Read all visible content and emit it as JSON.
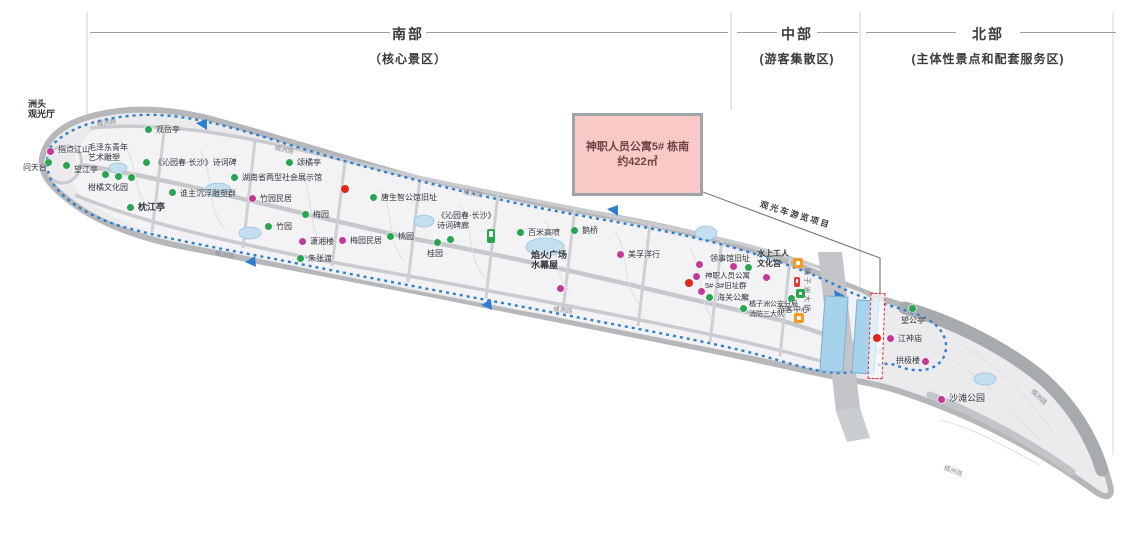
{
  "regions": {
    "south": {
      "title": "南部",
      "subtitle": "（核心景区）"
    },
    "middle": {
      "title": "中部",
      "subtitle": "(游客集散区)"
    },
    "north": {
      "title": "北部",
      "subtitle": "(主体性景点和配套服务区)"
    }
  },
  "callout": {
    "line1": "神职人员公寓5# 栋南",
    "line2": "约422㎡"
  },
  "colors": {
    "green_poi": "#28a550",
    "magenta_poi": "#c23a97",
    "red_poi": "#e3241d",
    "route_blue": "#2f7fd0",
    "callout_fill": "#f8c9c6",
    "callout_text": "#6d4543",
    "island_fill": "#ebebed",
    "island_band": "#b5b7ba",
    "pool_blue": "#a6d2ec"
  },
  "map": {
    "pois": [
      {
        "dot": "magenta",
        "x": 50,
        "y": 151,
        "label": "指点江山",
        "lx": 58,
        "ly": 145
      },
      {
        "dot": "green",
        "x": 48,
        "y": 162,
        "label": "问天台",
        "lx": 23,
        "ly": 163
      },
      {
        "dot": "green",
        "x": 66,
        "y": 165,
        "label": "望江亭",
        "lx": 74,
        "ly": 165
      },
      {
        "dot": "green",
        "x": 105,
        "y": 174
      },
      {
        "dot": "green",
        "x": 118,
        "y": 176
      },
      {
        "dot": "green",
        "x": 131,
        "y": 177
      },
      {
        "dot": "green",
        "x": 148,
        "y": 129,
        "label": "观岳亭",
        "lx": 156,
        "ly": 125
      },
      {
        "dot": "green",
        "x": 146,
        "y": 162,
        "label": "《沁园春·长沙》诗词碑",
        "lx": 154,
        "ly": 158
      },
      {
        "dot": "green",
        "x": 172,
        "y": 192,
        "label": "谁主沉浮雕塑群",
        "lx": 180,
        "ly": 189
      },
      {
        "dot": "green",
        "x": 130,
        "y": 207,
        "label": "枕江亭",
        "lx": 138,
        "ly": 203,
        "bold": true,
        "size": 9
      },
      {
        "dot": "green",
        "x": 234,
        "y": 177,
        "label": "湖南省两型社会展示馆",
        "lx": 242,
        "ly": 173
      },
      {
        "dot": "green",
        "x": 289,
        "y": 162,
        "label": "颂橘亭",
        "lx": 297,
        "ly": 158
      },
      {
        "dot": "magenta",
        "x": 252,
        "y": 198,
        "label": "竹园民居",
        "lx": 260,
        "ly": 194
      },
      {
        "dot": "green",
        "x": 268,
        "y": 226,
        "label": "竹园",
        "lx": 276,
        "ly": 222
      },
      {
        "dot": "green",
        "x": 305,
        "y": 214,
        "label": "梅园",
        "lx": 313,
        "ly": 210
      },
      {
        "dot": "magenta",
        "x": 302,
        "y": 241,
        "label": "潇湘楼",
        "lx": 310,
        "ly": 237
      },
      {
        "dot": "magenta",
        "x": 342,
        "y": 240,
        "label": "梅园民居",
        "lx": 350,
        "ly": 236
      },
      {
        "dot": "green",
        "x": 300,
        "y": 258,
        "label": "朱张渡",
        "lx": 308,
        "ly": 254
      },
      {
        "dot": "red",
        "x": 345,
        "y": 189
      },
      {
        "dot": "green",
        "x": 373,
        "y": 197,
        "label": "唐生智公馆旧址",
        "lx": 381,
        "ly": 193
      },
      {
        "dot": "green",
        "x": 390,
        "y": 236,
        "label": "桃园",
        "lx": 398,
        "ly": 232
      },
      {
        "dot": "green",
        "x": 437,
        "y": 242,
        "label": "桂园",
        "lx": 427,
        "ly": 249
      },
      {
        "dot": "green",
        "x": 450,
        "y": 239
      },
      {
        "dot": "green",
        "x": 520,
        "y": 232,
        "label": "百米高喷",
        "lx": 528,
        "ly": 228
      },
      {
        "dot": "green",
        "x": 574,
        "y": 230,
        "label": "鹅桥",
        "lx": 582,
        "ly": 226
      },
      {
        "dot": "magenta",
        "x": 560,
        "y": 288
      },
      {
        "dot": "magenta",
        "x": 620,
        "y": 254,
        "label": "美孚洋行",
        "lx": 628,
        "ly": 250
      },
      {
        "dot": "magenta",
        "x": 699,
        "y": 264
      },
      {
        "dot": "magenta",
        "x": 696,
        "y": 276
      },
      {
        "dot": "magenta",
        "x": 701,
        "y": 291
      },
      {
        "dot": "red",
        "x": 689,
        "y": 283
      },
      {
        "dot": "magenta",
        "x": 733,
        "y": 266,
        "label": "领事馆旧址",
        "lx": 710,
        "ly": 254
      },
      {
        "dot": "green",
        "x": 748,
        "y": 267
      },
      {
        "dot": "magenta",
        "x": 766,
        "y": 277
      },
      {
        "dot": "green",
        "x": 709,
        "y": 297,
        "label": "海关公廨",
        "lx": 717,
        "ly": 293
      },
      {
        "dot": "green",
        "x": 743,
        "y": 308
      },
      {
        "dot": "green",
        "x": 791,
        "y": 298,
        "label": "游客中心",
        "lx": 777,
        "ly": 305
      },
      {
        "dot": "red",
        "x": 877,
        "y": 338
      },
      {
        "dot": "green",
        "x": 912,
        "y": 308,
        "label": "望公亭",
        "lx": 901,
        "ly": 316
      },
      {
        "dot": "magenta",
        "x": 890,
        "y": 338,
        "label": "江神庙",
        "lx": 898,
        "ly": 334
      },
      {
        "dot": "magenta",
        "x": 925,
        "y": 361,
        "label": "拱极楼",
        "lx": 896,
        "ly": 356
      },
      {
        "dot": "magenta",
        "x": 941,
        "y": 399,
        "label": "沙滩公园",
        "lx": 949,
        "ly": 394,
        "size": 9
      }
    ],
    "text_blocks": [
      {
        "name": "zhoutou-viewing-hall",
        "lines": [
          "洲头",
          "观光厅"
        ],
        "x": 28,
        "y": 100,
        "size": 9,
        "bold": true
      },
      {
        "name": "mao-youth-sculpture",
        "lines": [
          "毛泽东青年",
          "艺术雕塑"
        ],
        "x": 88,
        "y": 143,
        "size": 8
      },
      {
        "name": "citrus-culture-garden",
        "lines": [
          "柑橘文化园"
        ],
        "x": 88,
        "y": 183,
        "size": 8
      },
      {
        "name": "poem-stele-gallery",
        "lines": [
          "《沁园春·长沙》",
          "诗词碑廊"
        ],
        "x": 437,
        "y": 211,
        "size": 8
      },
      {
        "name": "fireworks-square",
        "lines": [
          "焰火广场",
          "水幕屋"
        ],
        "x": 531,
        "y": 251,
        "size": 9,
        "bold": true
      },
      {
        "name": "clergy-apartments-group",
        "lines": [
          "神职人员公寓",
          "5#·3#旧址群"
        ],
        "x": 705,
        "y": 271,
        "size": 7.5
      },
      {
        "name": "waterside-workers-culture-palace",
        "lines": [
          "水上工人",
          "文化宫"
        ],
        "x": 757,
        "y": 249,
        "size": 8,
        "bold": true
      },
      {
        "name": "police-station",
        "lines": [
          "橘子洲公安分局",
          "消防三大队"
        ],
        "x": 749,
        "y": 300,
        "size": 7
      }
    ],
    "rotated_labels": [
      {
        "name": "sightseeing-bus-route",
        "text": "观光车游览项目",
        "x": 762,
        "y": 198,
        "rot": 17,
        "size": 8.5,
        "color": "#3c4043",
        "bold": true
      },
      {
        "name": "juzizhou-bridge",
        "text": "橘子洲大桥",
        "x": 812,
        "y": 268,
        "rot": 90,
        "size": 7,
        "color": "#6b6f73"
      }
    ],
    "road_labels": [
      {
        "text": "橘洲路",
        "x": 96,
        "y": 118,
        "rot": -8
      },
      {
        "text": "橘洲路",
        "x": 276,
        "y": 142,
        "rot": 12
      },
      {
        "text": "橘洲路",
        "x": 464,
        "y": 186,
        "rot": 10
      },
      {
        "text": "橘洲路",
        "x": 216,
        "y": 247,
        "rot": 10
      },
      {
        "text": "橘洲路",
        "x": 554,
        "y": 303,
        "rot": 8
      },
      {
        "text": "橘洲路",
        "x": 1036,
        "y": 386,
        "rot": 44
      },
      {
        "text": "橘洲路",
        "x": 946,
        "y": 462,
        "rot": 20
      }
    ],
    "facility_icons": [
      {
        "kind": "orange",
        "x": 793,
        "y": 258,
        "w": 10,
        "h": 10
      },
      {
        "kind": "red",
        "x": 794,
        "y": 277,
        "w": 6,
        "h": 10
      },
      {
        "kind": "green",
        "x": 796,
        "y": 289,
        "w": 9,
        "h": 9
      },
      {
        "kind": "orange",
        "x": 794,
        "y": 313,
        "w": 10,
        "h": 10
      },
      {
        "kind": "green",
        "x": 487,
        "y": 229,
        "w": 8,
        "h": 14
      }
    ]
  }
}
